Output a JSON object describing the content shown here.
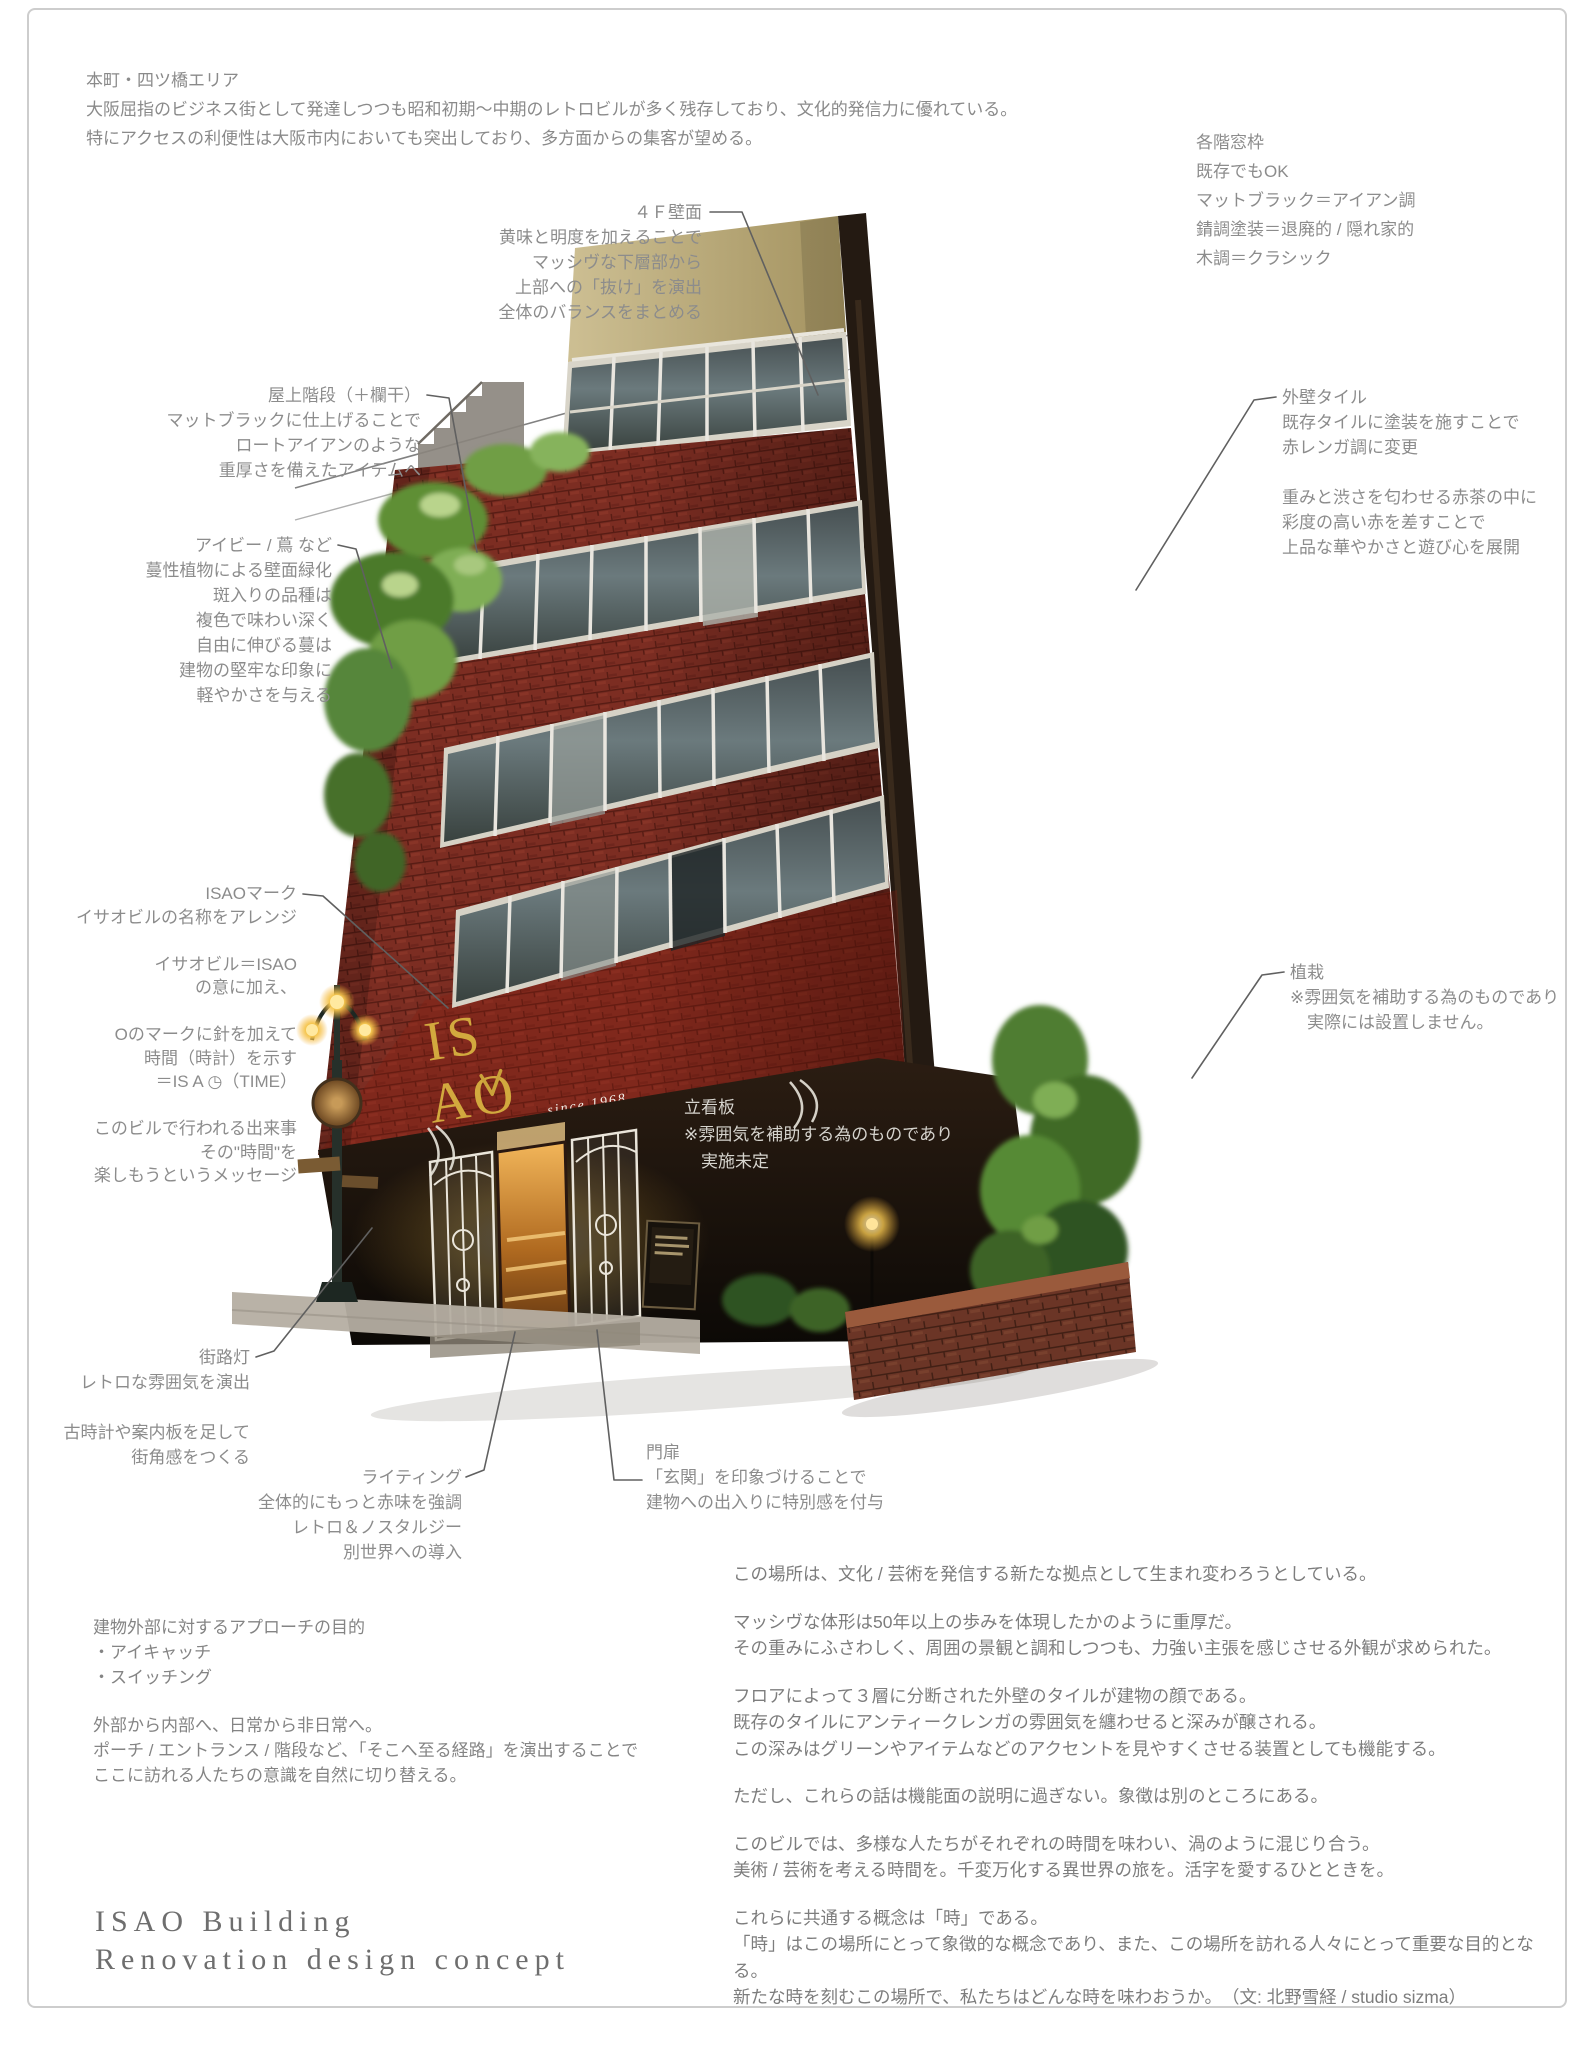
{
  "intro": "本町・四ツ橋エリア\n大阪屈指のビジネス街として発達しつつも昭和初期～中期のレトロビルが多く残存しており、文化的発信力に優れている。\n特にアクセスの利便性は大阪市内においても突出しており、多方面からの集客が望める。",
  "notes": {
    "window_frames": "各階窓枠\n既存でもOK\nマットブラック＝アイアン調\n錆調塗装＝退廃的 / 隠れ家的\n木調＝クラシック"
  },
  "annotations": {
    "wall_4f": "４Ｆ壁面\n黄味と明度を加えることで\nマッシヴな下層部から\n上部への「抜け」を演出\n全体のバランスをまとめる",
    "rooftop_stairs": "屋上階段（＋欄干）\nマットブラックに仕上げることで\nロートアイアンのような\n重厚さを備えたアイテムへ",
    "ivy": "アイビー / 蔦 など\n蔓性植物による壁面緑化\n斑入りの品種は\n複色で味わい深く\n自由に伸びる蔓は\n建物の堅牢な印象に\n軽やかさを与える",
    "exterior_tiles": "外壁タイル\n既存タイルに塗装を施すことで\n赤レンガ調に変更\n\n重みと渋さを匂わせる赤茶の中に\n彩度の高い赤を差すことで\n上品な華やかさと遊び心を展開",
    "isao_mark": "ISAOマーク\nイサオビルの名称をアレンジ\n\nイサオビル＝ISAO\nの意に加え、\n\nOのマークに針を加えて\n時間（時計）を示す\n＝IS A ◷（TIME）\n\nこのビルで行われる出来事\nその\"時間\"を\n楽しもうというメッセージ",
    "planting": "植栽\n※雰囲気を補助する為のものであり\n　実際には設置しません。",
    "standing_sign": "立看板\n※雰囲気を補助する為のものであり\n　実施未定",
    "street_lamp": "街路灯\nレトロな雰囲気を演出\n\n古時計や案内板を足して\n街角感をつくる",
    "lighting": "ライティング\n全体的にもっと赤味を強調\nレトロ＆ノスタルジー\n別世界への導入",
    "gate": "門扉\n「玄関」を印象づけることで\n建物への出入りに特別感を付与"
  },
  "approach": {
    "purpose": "建物外部に対するアプローチの目的\n・アイキャッチ\n・スイッチング",
    "flow": "外部から内部へ、日常から非日常へ。\nポーチ / エントランス / 階段など、「そこへ至る経路」を演出することで\nここに訪れる人たちの意識を自然に切り替える。"
  },
  "closing": {
    "p1": "この場所は、文化 / 芸術を発信する新たな拠点として生まれ変わろうとしている。",
    "p2": "マッシヴな体形は50年以上の歩みを体現したかのように重厚だ。\nその重みにふさわしく、周囲の景観と調和しつつも、力強い主張を感じさせる外観が求められた。",
    "p3": "フロアによって３層に分断された外壁のタイルが建物の顔である。\n既存のタイルにアンティークレンガの雰囲気を纏わせると深みが醸される。\nこの深みはグリーンやアイテムなどのアクセントを見やすくさせる装置としても機能する。",
    "p4": "ただし、これらの話は機能面の説明に過ぎない。象徴は別のところにある。",
    "p5": "このビルでは、多様な人たちがそれぞれの時間を味わい、渦のように混じり合う。\n美術 / 芸術を考える時間を。千変万化する異世界の旅を。活字を愛するひとときを。",
    "p6": "これらに共通する概念は「時」である。\n「時」はこの場所にとって象徴的な概念であり、また、この場所を訪れる人々にとって重要な目的となる。\n新たな時を刻むこの場所で、私たちはどんな時を味わおうか。　（文: 北野雪経 / studio sizma）"
  },
  "title": "ISAO Building\nRenovation design concept",
  "building": {
    "logo_top": "IS",
    "logo_bottom": "AO",
    "since": "since 1968"
  },
  "colors": {
    "brick_red": "#7c2d22",
    "khaki_wall": "#b8a878",
    "logo_gold": "#d2a93e",
    "annotation_gray": "#8c8c8c",
    "frame_gray": "#cdcdcd"
  }
}
